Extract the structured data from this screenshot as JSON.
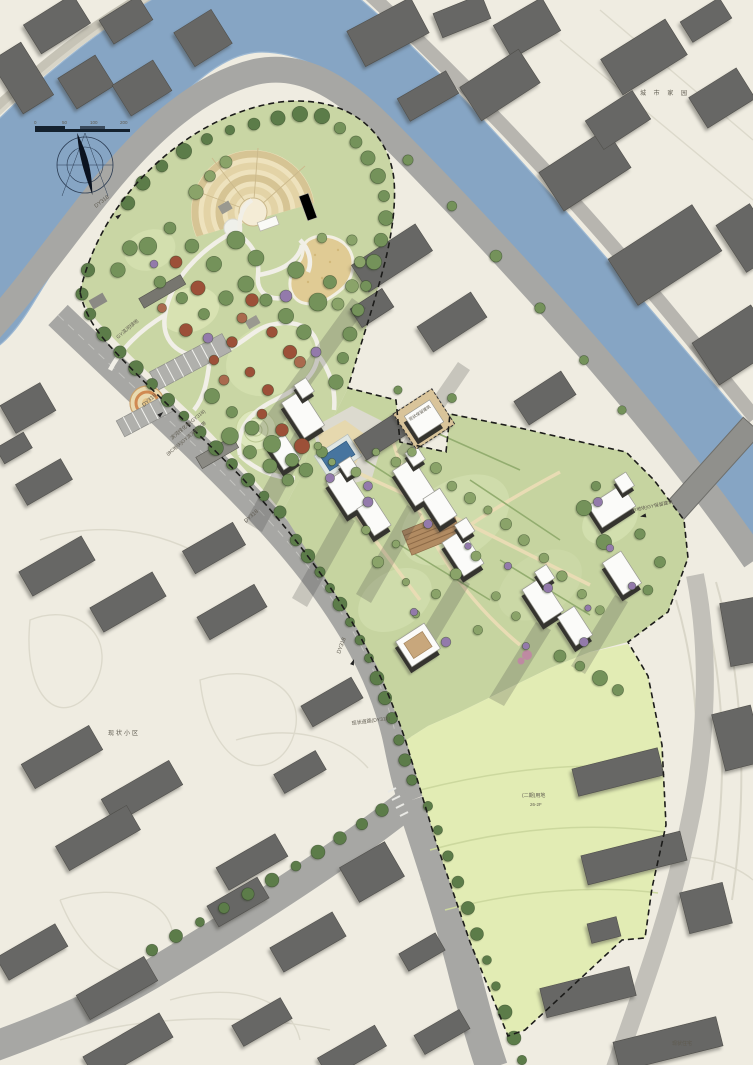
{
  "plan": {
    "kind": "landscape-masterplan",
    "colors": {
      "background": "#efece1",
      "river": "#86a5c4",
      "road_major": "#a7a7a4",
      "road_minor": "#b7b5af",
      "park_green": "#c9d6a4",
      "lawn_green": "#d3dfae",
      "site_green": "#c6d4a0",
      "field_green": "#e2ecb4",
      "context_building": "#676765",
      "white_building": "#fbfbf9",
      "building_shadow": "#35342f",
      "pool_water": "#47759f",
      "sand": "#e0cb94",
      "tree_green": "#74925a",
      "tree_red": "#9c5038",
      "tree_purple": "#937aab",
      "boundary": "#1c1c1a"
    }
  },
  "scale_bar": {
    "labels": [
      "0",
      "50",
      "100",
      "200"
    ]
  },
  "annotations": {
    "road_code_nw": {
      "text": "DY318"
    },
    "road_code_w": {
      "text": "DY318"
    },
    "road_code_mid": {
      "text": "DY318"
    },
    "road_code_s": {
      "text": "DY318"
    },
    "greenbelt_nw": {
      "text": "GY滨河绿地"
    },
    "greenbelt_sw": {
      "text": "滨河绿化带(GY318)"
    },
    "parcel_bc": {
      "text": "(BC地块)GY滨河绿化带"
    },
    "road_name_s": {
      "text": "现状道路(DY318)"
    },
    "parcel_b": {
      "text": "(B地块)GY保留建筑"
    },
    "kept_building": {
      "text": "现状保留建筑"
    },
    "field_line1": {
      "text": "(二期)用地"
    },
    "field_line2": {
      "text": "26-2F"
    },
    "estate_w": {
      "text": "现状小区"
    },
    "estate_ne": {
      "text": "城 市 家 园"
    },
    "estate_se": {
      "text": "现状住宅"
    }
  }
}
